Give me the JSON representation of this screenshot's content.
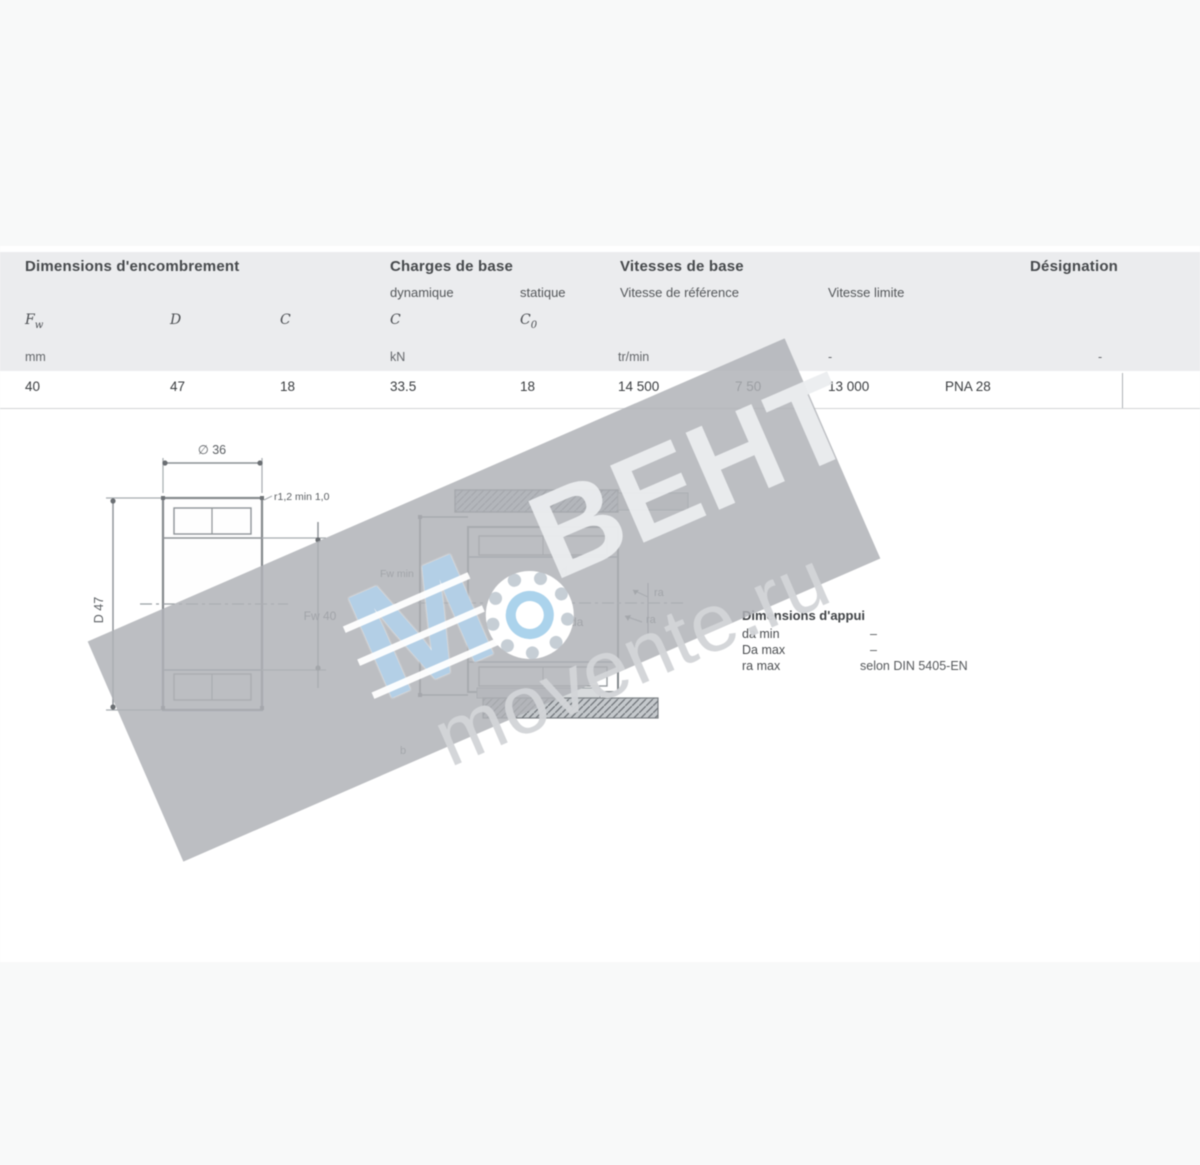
{
  "table": {
    "groups": [
      {
        "label": "Dimensions d'encombrement"
      },
      {
        "label": "Charges de base"
      },
      {
        "label": "Vitesses de base"
      },
      {
        "label": "Désignation"
      }
    ],
    "subheaders": {
      "dyn": "dynamique",
      "stat": "statique",
      "vref": "Vitesse de référence",
      "vlim": "Vitesse limite"
    },
    "symbols": [
      {
        "main": "F",
        "sub": "w"
      },
      {
        "main": "D",
        "sub": ""
      },
      {
        "main": "C",
        "sub": ""
      },
      {
        "main": "C",
        "sub": ""
      },
      {
        "main": "C",
        "sub": "0"
      }
    ],
    "units": {
      "dim": "mm",
      "load": "kN",
      "speed": "tr/min",
      "dash_mid": "-",
      "dash_right": "-"
    },
    "row": {
      "fw": "40",
      "d": "47",
      "c": "18",
      "c_dyn": "33.5",
      "c_stat": "18",
      "v_ref": "14 500",
      "v_mid": "7 50",
      "v_lim": "13 000",
      "designation": "PNA 28"
    }
  },
  "drawing_left": {
    "dim_top": "∅ 36",
    "dim_left": "D 47",
    "dim_right": "Fw 40",
    "chamfer": "r1,2 min 1,0"
  },
  "drawing_right": {
    "label_fw": "Fw min",
    "label_D": "D",
    "label_d": "d",
    "label_da": "da",
    "label_ra1": "ra",
    "label_ra2": "ra",
    "label_b": "b"
  },
  "notes": {
    "title": "Dimensions d'appui",
    "rows": [
      {
        "label": "da min",
        "value": "–"
      },
      {
        "label": "Da max",
        "value": "–"
      },
      {
        "label": "ra max",
        "value": "selon DIN 5405-EN"
      }
    ]
  },
  "watermark": {
    "brand": "ВЕНТ",
    "domain": "movente.ru",
    "logo_letter": "M",
    "band_gray": "#afb2b6",
    "logo_blue": "#abd3ec"
  }
}
